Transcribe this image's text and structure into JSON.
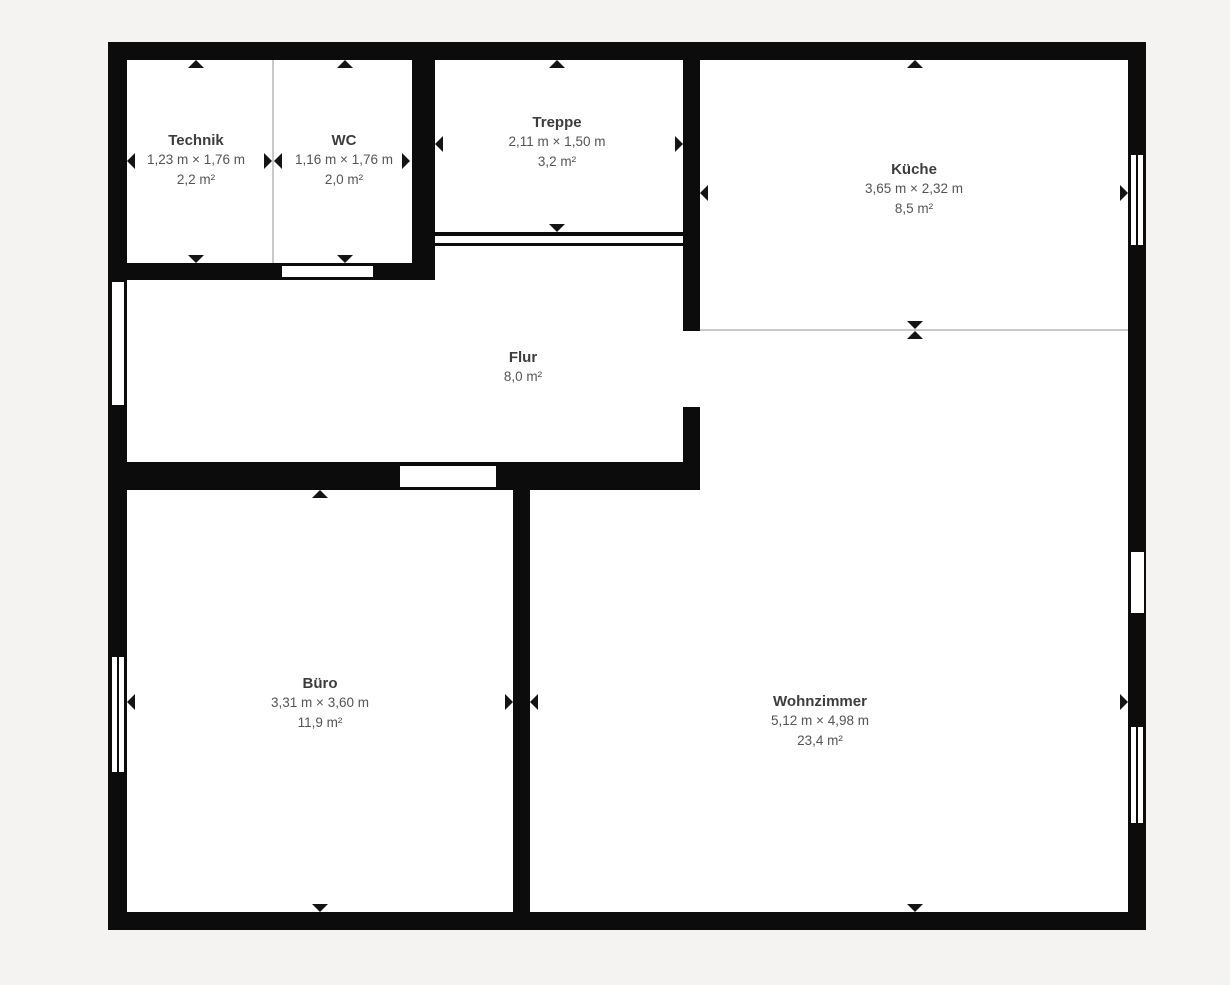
{
  "plan": {
    "type": "floorplan",
    "language": "de",
    "colors": {
      "background": "#f4f3f1",
      "wall": "#0c0c0c",
      "floor": "#ffffff",
      "room_name": "#3d3d3d",
      "room_info": "#545454",
      "thin_divider": "#c9c9c9"
    },
    "rooms": [
      {
        "name": "Technik",
        "dims": "1,23 m × 1,76 m",
        "area": "2,2 m²"
      },
      {
        "name": "WC",
        "dims": "1,16 m × 1,76 m",
        "area": "2,0 m²"
      },
      {
        "name": "Treppe",
        "dims": "2,11 m × 1,50 m",
        "area": "3,2 m²"
      },
      {
        "name": "Küche",
        "dims": "3,65 m × 2,32 m",
        "area": "8,5 m²"
      },
      {
        "name": "Flur",
        "dims": "",
        "area": "8,0 m²"
      },
      {
        "name": "Büro",
        "dims": "3,31 m × 3,60 m",
        "area": "11,9 m²"
      },
      {
        "name": "Wohnzimmer",
        "dims": "5,12 m × 4,98 m",
        "area": "23,4 m²"
      }
    ]
  }
}
